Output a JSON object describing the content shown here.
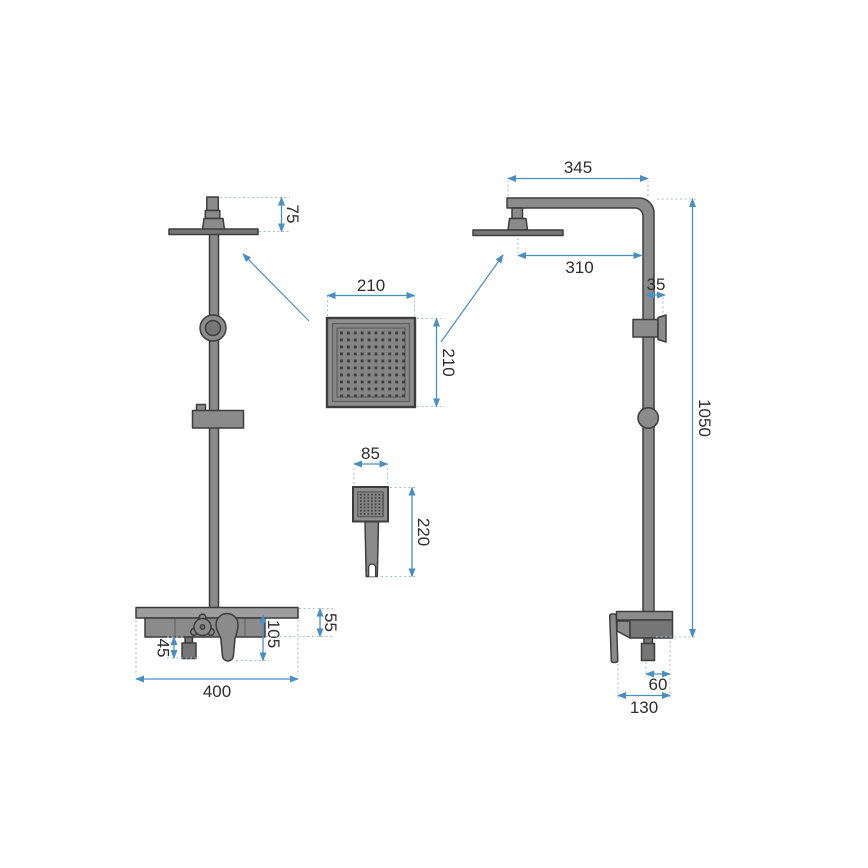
{
  "drawing_name": "shower-set-technical-drawing",
  "colors": {
    "background": "#ffffff",
    "fixture_fill": "#8b8b8b",
    "fixture_light": "#9d9d9d",
    "fixture_dark": "#767676",
    "outline": "#3d3d3d",
    "dimension": "#4a8fc2",
    "extension": "#b0bec9",
    "text_color": "#2d2d2d",
    "nozzle": "#3e3e3e"
  },
  "dims": {
    "front": {
      "head_offset": "75",
      "outlet_height": "45",
      "lever_drop": "105",
      "bar_height": "55",
      "total_width": "400"
    },
    "side": {
      "arm_length": "345",
      "head_reach": "310",
      "bracket_offset": "35",
      "column_height": "1050",
      "outlet_offset": "60",
      "body_depth": "130"
    },
    "rain_head": {
      "width": "210",
      "height": "210"
    },
    "hand_shower": {
      "width": "85",
      "length": "220"
    }
  }
}
